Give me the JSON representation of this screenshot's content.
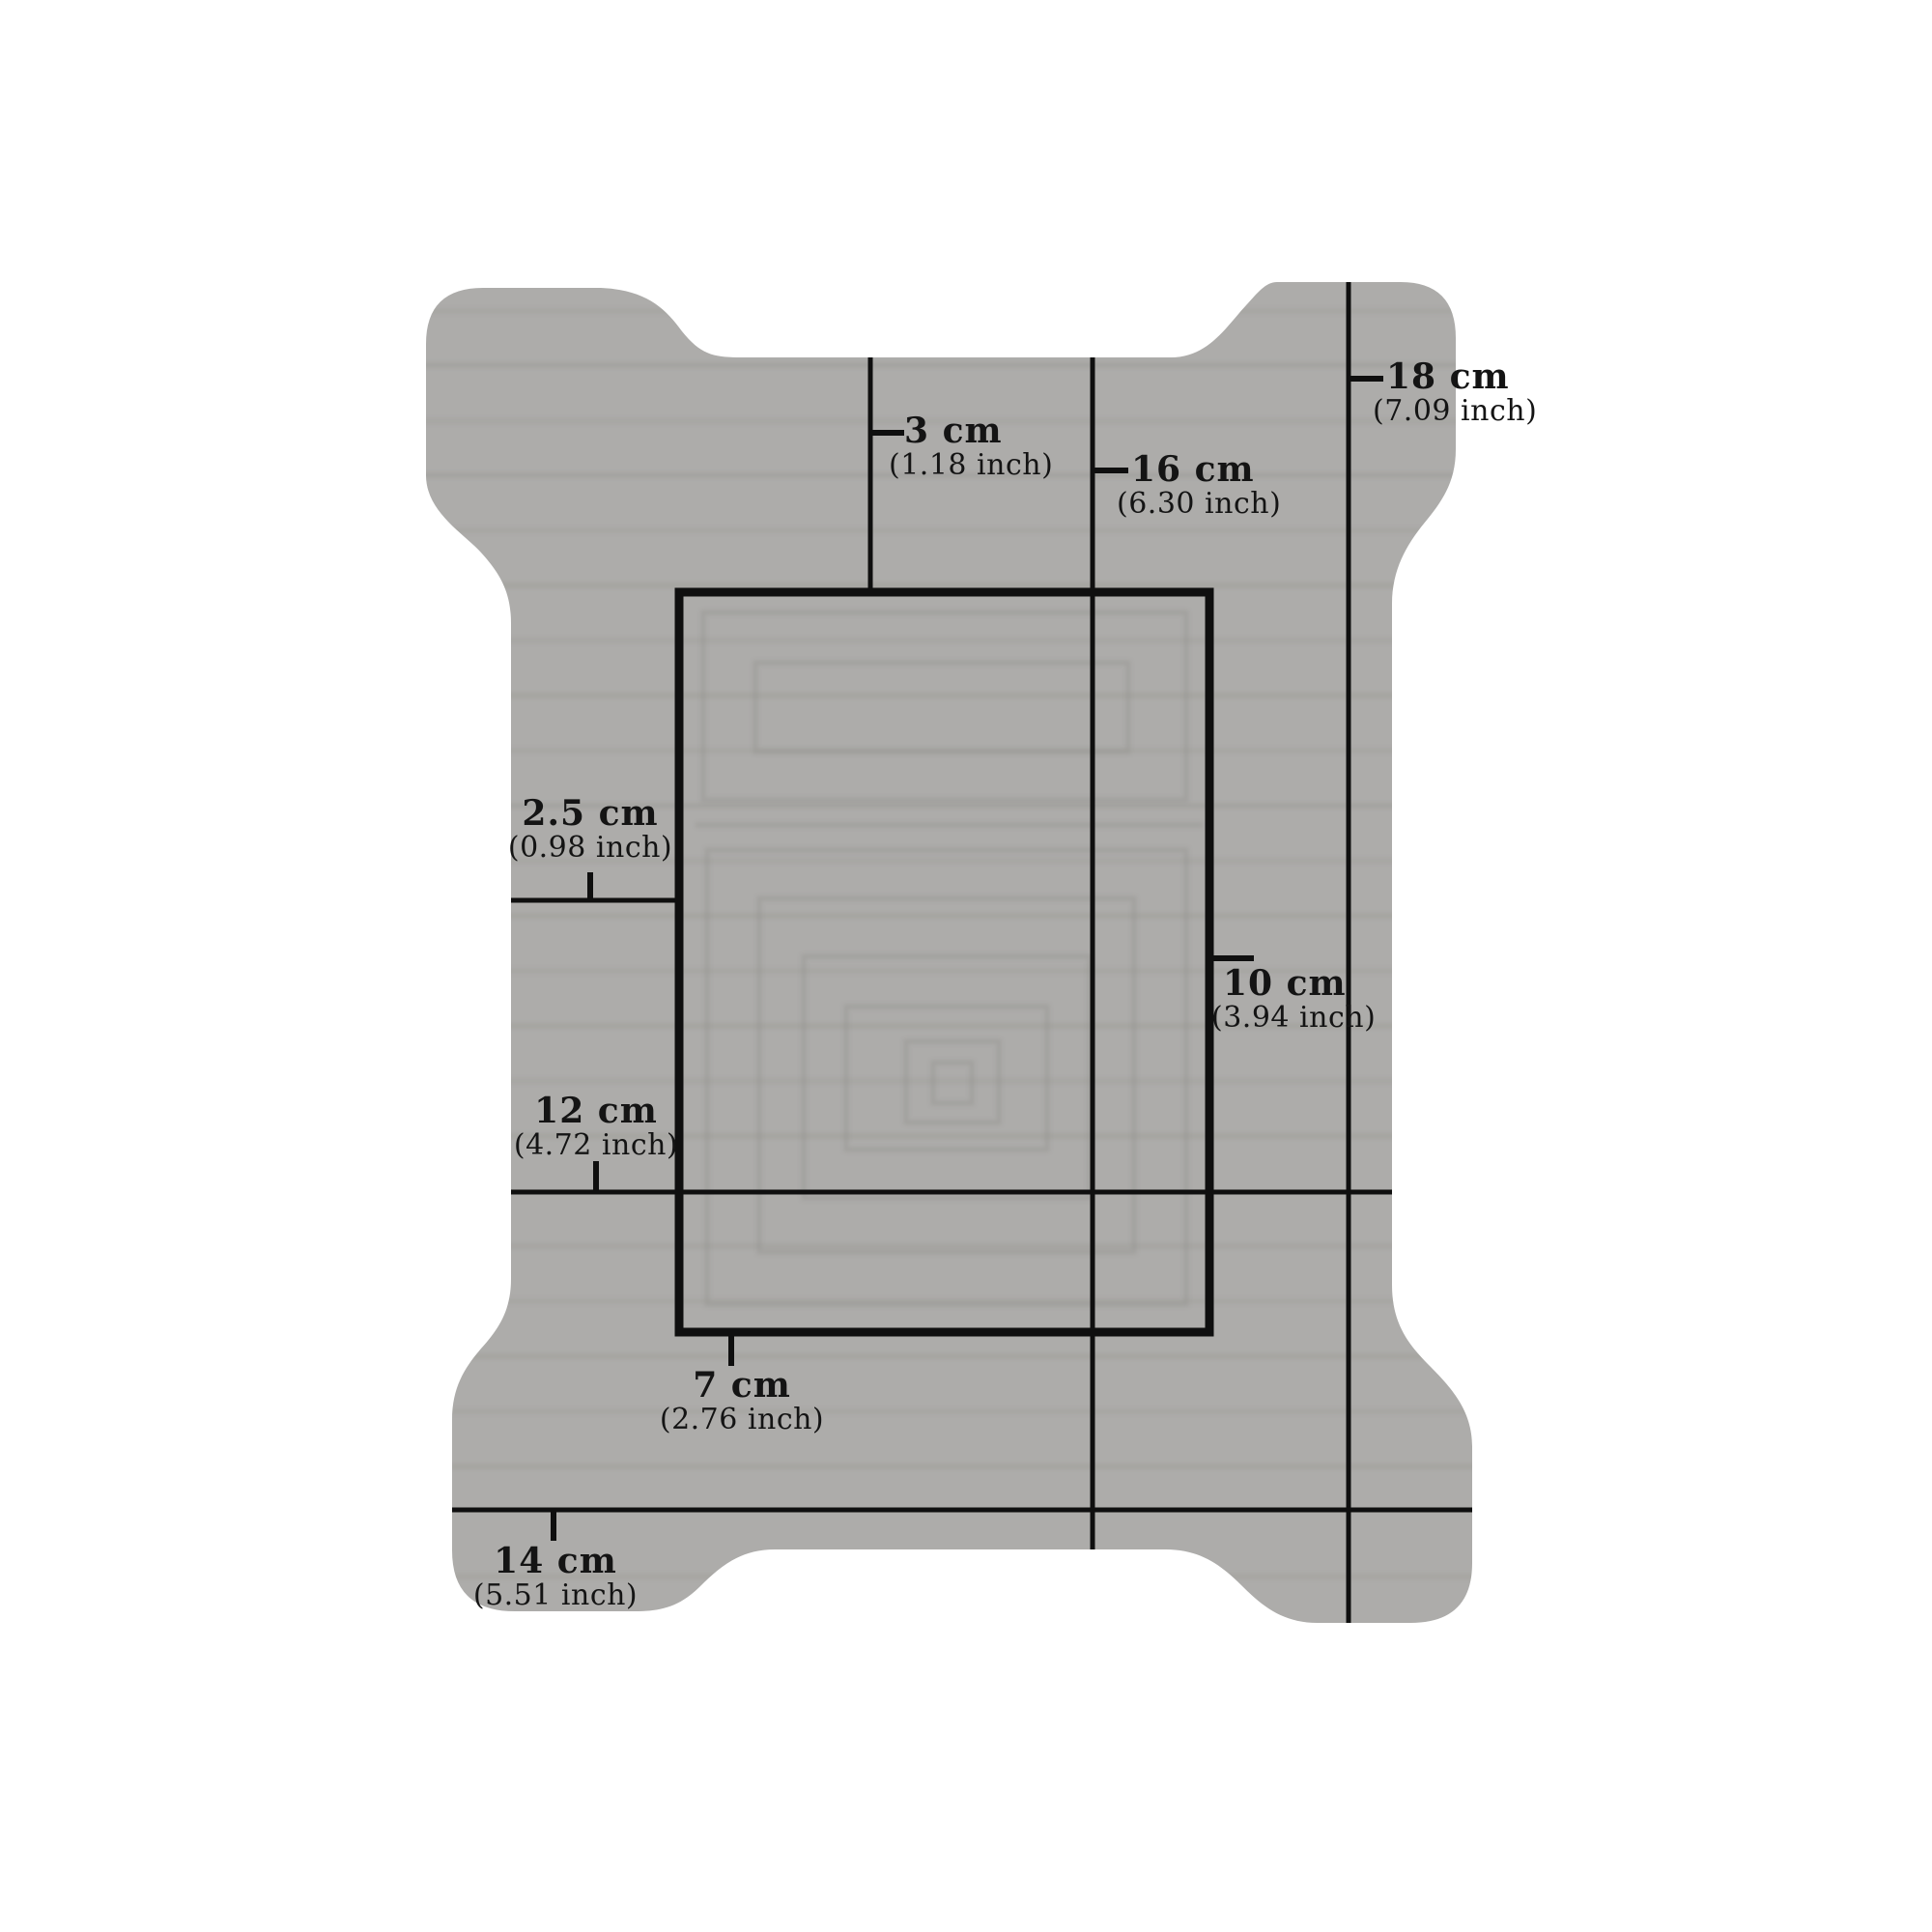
{
  "figure": {
    "description": "Dimension diagram of a die-cut corrugated cardboard blank with four rounded corner lobes and a marked rectangular score outline"
  },
  "colors": {
    "background": "#ffffff",
    "shape": "#adacaa",
    "stripe": "#96958f",
    "emboss": "#8f8e8a",
    "ink": "#141414",
    "line": "#0f0f0f"
  },
  "labels": [
    {
      "name": "3cm",
      "value": "3 cm",
      "inch": "(1.18 inch)"
    },
    {
      "name": "16cm",
      "value": "16 cm",
      "inch": "(6.30 inch)"
    },
    {
      "name": "18cm",
      "value": "18 cm",
      "inch": "(7.09 inch)"
    },
    {
      "name": "2.5cm",
      "value": "2.5 cm",
      "inch": "(0.98 inch)"
    },
    {
      "name": "10cm",
      "value": "10 cm",
      "inch": "(3.94 inch)"
    },
    {
      "name": "12cm",
      "value": "12 cm",
      "inch": "(4.72 inch)"
    },
    {
      "name": "7cm",
      "value": "7 cm",
      "inch": "(2.76 inch)"
    },
    {
      "name": "14cm",
      "value": "14 cm",
      "inch": "(5.51 inch)"
    }
  ]
}
